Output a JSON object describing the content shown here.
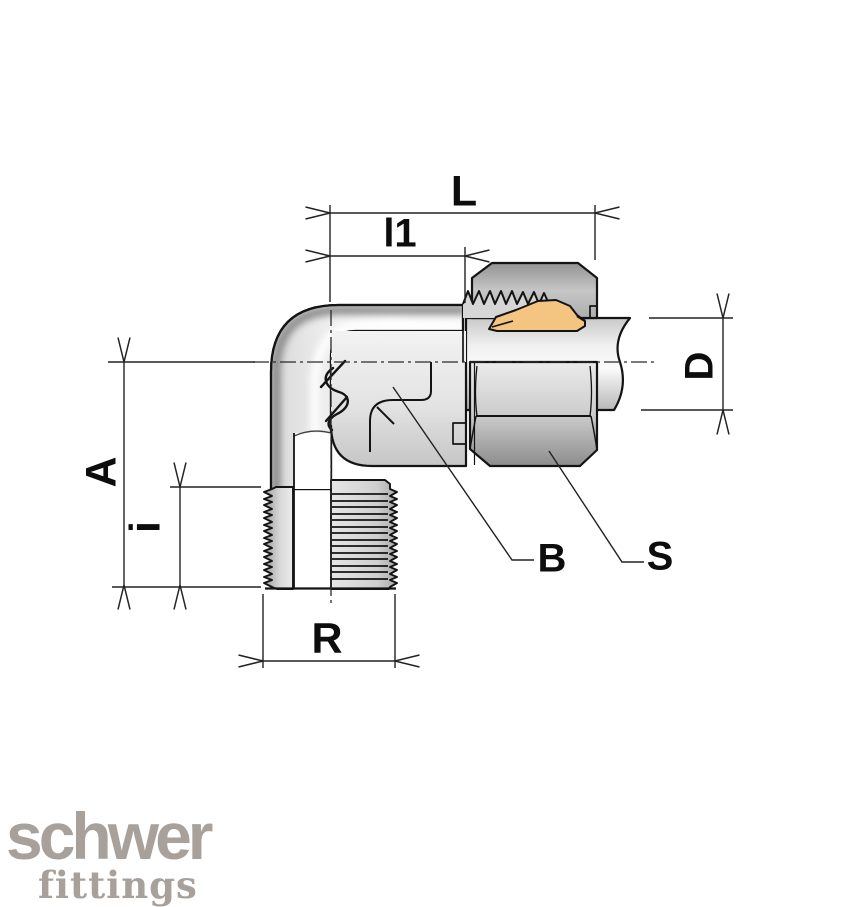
{
  "diagram": {
    "type": "technical-drawing",
    "subject": "90-degree elbow compression tube fitting with male taper thread, half-section view",
    "dimension_labels": {
      "L": "L",
      "l1": "l1",
      "A": "A",
      "i": "i",
      "R": "R",
      "D": "D"
    },
    "callout_labels": {
      "B": "B",
      "S": "S"
    },
    "colors": {
      "outline": "#141414",
      "dimension_line": "#222222",
      "metal_light": "#ededed",
      "metal_mid": "#c9c9c9",
      "metal_dark": "#8f8f8f",
      "ferrule": "#f3c581",
      "background": "#ffffff"
    }
  },
  "logo": {
    "brand": "schwer",
    "subtitle": "fittings",
    "color": "#a8a19b"
  }
}
